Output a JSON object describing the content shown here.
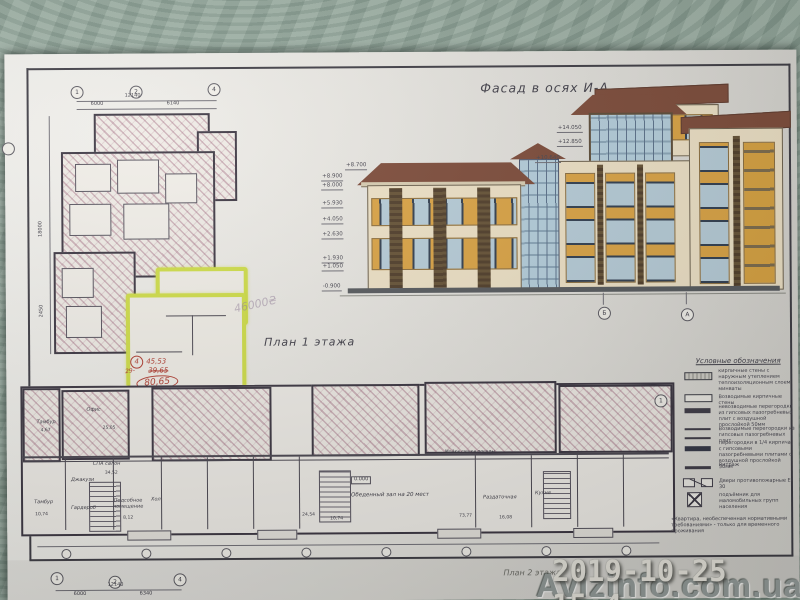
{
  "palette": {
    "highlighter": "#cadb30",
    "red_pen": "#b03a2e",
    "facade_wall": "#efe2c6",
    "facade_accent": "#dca342",
    "roof": "#7c4937",
    "glass": "#b7cdd9"
  },
  "overlay": {
    "timestamp": "2019-10-25 15:4",
    "watermark": "Avizinfo.com.ua"
  },
  "facade": {
    "title": "Фасад в осях И-А",
    "marks_left": [
      "+8.700",
      "+8.900",
      "+8.000",
      "+5.930",
      "+4.050",
      "+2.630",
      "+1.930",
      "+1.050",
      "-0.900"
    ],
    "marks_right": [
      "+14.050",
      "+12.850",
      "+10.640"
    ],
    "axis_left_label": "Б",
    "axis_right_label": "А"
  },
  "plan1": {
    "title": "План 1 этажа",
    "axes": {
      "a1": "1",
      "a2": "2",
      "a4": "4"
    },
    "dims": {
      "top_total": "12140",
      "top_left": "6000",
      "top_right": "6140",
      "left_total": "18000",
      "left_lower": "2450"
    },
    "pencil_note": "46000₴",
    "annotations": {
      "apartment_number": "4",
      "prefix": "29-",
      "area_rooms": "45,53",
      "area_struck": "39,65",
      "area_total": "80,65",
      "area_extra": "69,46"
    },
    "elevation_zero": "0.000",
    "end_axis": "1"
  },
  "rooms": [
    {
      "label": "Тамбур",
      "area": "4,67"
    },
    {
      "label": "Офис",
      "area": "25,05"
    },
    {
      "label": "СПА салон",
      "area": "34,52"
    },
    {
      "label": "Джакузи",
      "area": ""
    },
    {
      "label": "Тамбур",
      "area": "10,74"
    },
    {
      "label": "Гардероб",
      "area": ""
    },
    {
      "label": "Подсобное помещение",
      "area": "8,12"
    },
    {
      "label": "Хол",
      "area": ""
    },
    {
      "label": "Обеденный зал на 20 мест",
      "area": "73,77"
    },
    {
      "label": "Мойка сушка посуды",
      "area": ""
    },
    {
      "label": "Раздаточная",
      "area": ""
    },
    {
      "label": "Кухня",
      "area": "16,08"
    },
    {
      "label": "",
      "area": "24,54"
    },
    {
      "label": "",
      "area": "10,74"
    }
  ],
  "legend": {
    "title": "Условные обозначения",
    "items": [
      {
        "text": "кирпичные стены с наружным утеплением теплоизоляционным слоем минваты"
      },
      {
        "text": "Возводимые кирпичные стены"
      },
      {
        "text": "невозводимые перегородки из гипсовых пазогребневых плит с воздушной прослойкой 50мм"
      },
      {
        "text": "Возводимые перегородки из гипсовых пазогребневых плит"
      },
      {
        "text": "перегородки в 1/4 кирпича с гипсовыми пазогребневыми плитами с воздушной прослойкой 50мм"
      },
      {
        "text": "Витраж"
      },
      {
        "text": "Двери противопожарные EI 30"
      },
      {
        "text": "подъёмник для маломобильных групп населения"
      }
    ],
    "footnote": "«Квартира, необеспеченная нормативными требованиями» - только для временного проживания"
  },
  "next_sheet": {
    "title": "План 2 этажа",
    "axes": {
      "a1": "1",
      "a2": "2",
      "a4": "4"
    },
    "dims": {
      "total": "12140",
      "left": "6000",
      "right": "6340"
    }
  }
}
